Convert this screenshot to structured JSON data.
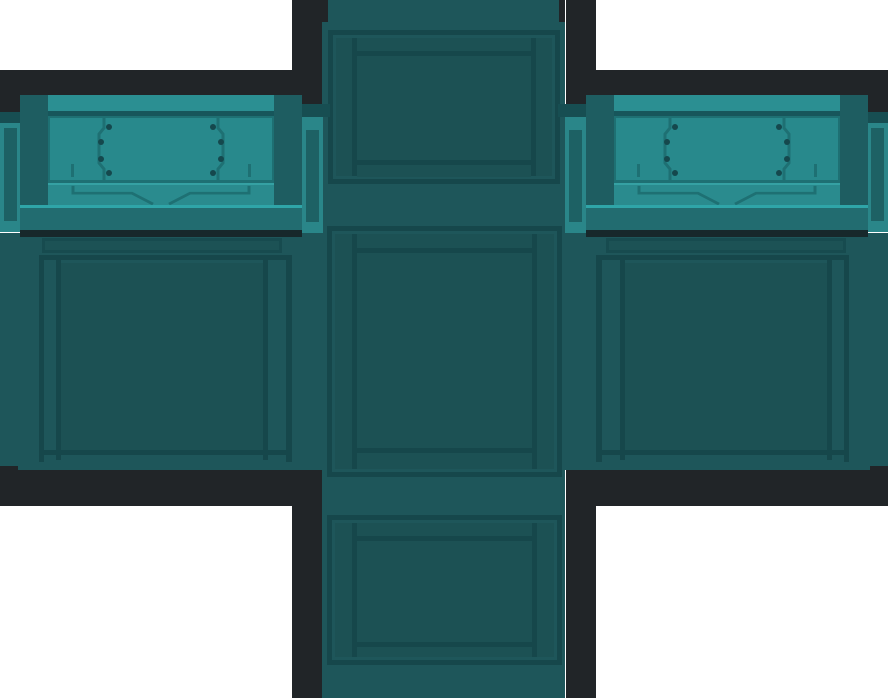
{
  "asset": {
    "kind": "game-texture-atlas",
    "description": "Unfolded sci-fi crate texture (cube net, cross layout) on white background",
    "faces": {
      "column_top": "top-face",
      "column_middle": "back-face",
      "column_bottom": "bottom-face",
      "wing_left": "left-face",
      "wing_right": "right-face"
    },
    "lid_plates": 2,
    "seams_per_plate": 2,
    "screws_per_plate": 8,
    "side_tabs": 4
  },
  "palette": {
    "canvas-bg": "#ffffff",
    "outline": "#212528",
    "body": "#1E565A",
    "panel-inner": "#1C5154",
    "frame-line": "#16474B",
    "groove-fill": "#1C5255",
    "groove-line": "#174B4F",
    "post": "#1E5D61",
    "lid-plate": "#28898C",
    "lid-bar": "#2B8F92",
    "lid-strip": "#2A8B8E",
    "lid-line": "#1E7073",
    "lid-edge-dark": "#17565B",
    "screw": "#15484D",
    "rail": "#226C70",
    "rail-highlight": "#2FA5A8",
    "rail-shadow": "#17282B",
    "tab": "#2A8689",
    "tab-inner": "#1D6164",
    "band-dark": "#174E52",
    "highlight": "#35A1A3"
  }
}
